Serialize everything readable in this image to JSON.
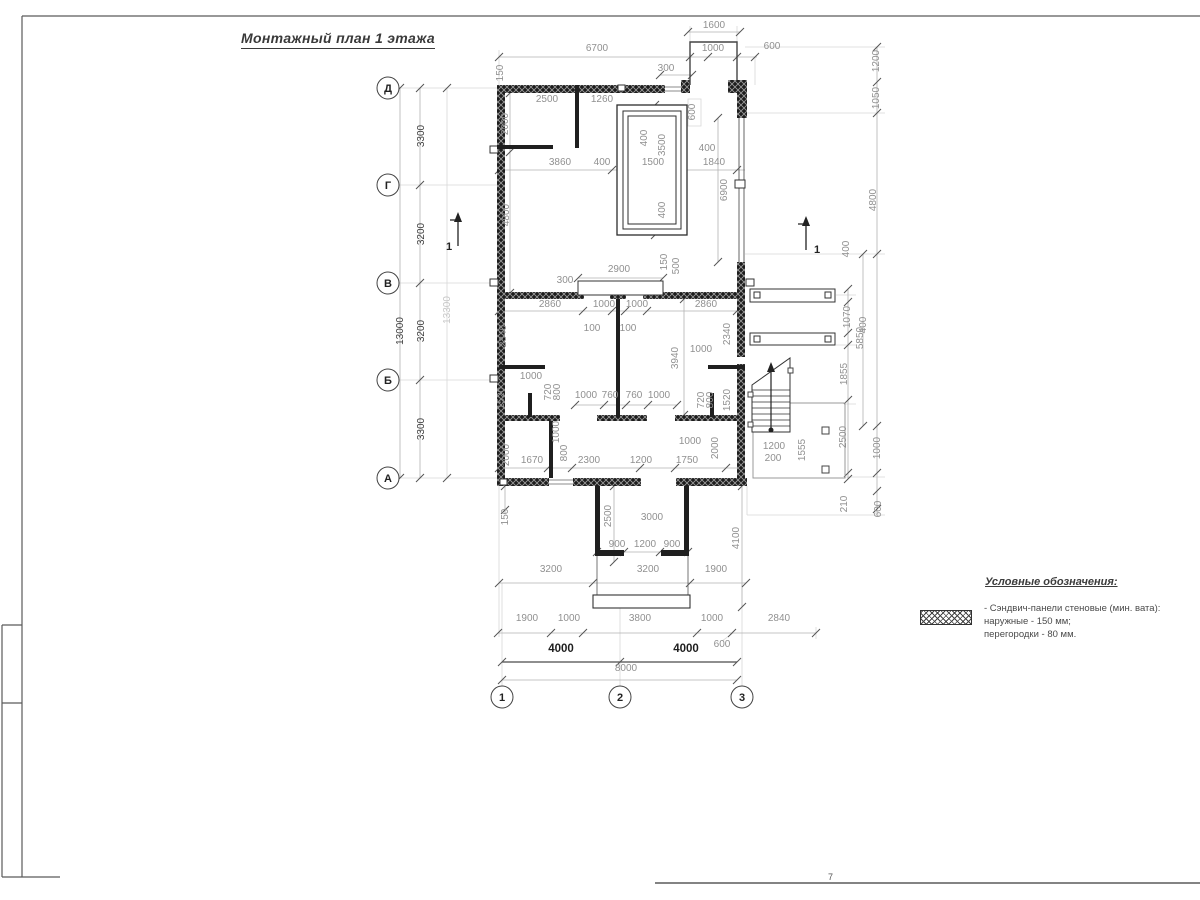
{
  "title": "Монтажный план 1 этажа",
  "sheet": {
    "corner_mark": "7"
  },
  "axes": {
    "left": [
      "Д",
      "Г",
      "В",
      "Б",
      "А"
    ],
    "bottom": [
      "1",
      "2",
      "3"
    ]
  },
  "sections": [
    "1",
    "1"
  ],
  "legend": {
    "heading": "Условные обозначения:",
    "symbol": "wall-panel-crosshatch",
    "lines": [
      "- Сэндвич-панели стеновые (мин. вата):",
      "наружные - 150 мм;",
      "перегородки - 80 мм."
    ]
  },
  "dimension_labels": [
    {
      "t": "1600",
      "x": 714,
      "y": 28
    },
    {
      "t": "6700",
      "x": 597,
      "y": 51
    },
    {
      "t": "1000",
      "x": 713,
      "y": 51
    },
    {
      "t": "600",
      "x": 772,
      "y": 49
    },
    {
      "t": "300",
      "x": 666,
      "y": 71
    },
    {
      "t": "150",
      "x": 503,
      "y": 73,
      "r": -90
    },
    {
      "t": "2500",
      "x": 547,
      "y": 102
    },
    {
      "t": "1260",
      "x": 602,
      "y": 102
    },
    {
      "t": "2000",
      "x": 508,
      "y": 124,
      "r": -90
    },
    {
      "t": "600",
      "x": 695,
      "y": 112,
      "r": -90
    },
    {
      "t": "400",
      "x": 647,
      "y": 138,
      "r": -90
    },
    {
      "t": "3500",
      "x": 665,
      "y": 145,
      "r": -90
    },
    {
      "t": "400",
      "x": 707,
      "y": 151
    },
    {
      "t": "3860",
      "x": 560,
      "y": 165
    },
    {
      "t": "400",
      "x": 602,
      "y": 165
    },
    {
      "t": "1500",
      "x": 653,
      "y": 165
    },
    {
      "t": "1840",
      "x": 714,
      "y": 165
    },
    {
      "t": "400",
      "x": 665,
      "y": 210,
      "r": -90
    },
    {
      "t": "4800",
      "x": 509,
      "y": 215,
      "r": -90
    },
    {
      "t": "6900",
      "x": 727,
      "y": 190,
      "r": -90
    },
    {
      "t": "3300",
      "x": 424,
      "y": 136,
      "r": -90,
      "c": "d"
    },
    {
      "t": "3200",
      "x": 424,
      "y": 234,
      "r": -90,
      "c": "d"
    },
    {
      "t": "3200",
      "x": 424,
      "y": 331,
      "r": -90,
      "c": "d"
    },
    {
      "t": "3300",
      "x": 424,
      "y": 429,
      "r": -90,
      "c": "d"
    },
    {
      "t": "13000",
      "x": 403,
      "y": 331,
      "r": -90,
      "c": "d"
    },
    {
      "t": "13300",
      "x": 450,
      "y": 310,
      "r": -90,
      "c": "lt"
    },
    {
      "t": "2900",
      "x": 619,
      "y": 272
    },
    {
      "t": "300",
      "x": 565,
      "y": 283
    },
    {
      "t": "150",
      "x": 667,
      "y": 262,
      "r": -90
    },
    {
      "t": "500",
      "x": 679,
      "y": 266,
      "r": -90
    },
    {
      "t": "2860",
      "x": 550,
      "y": 307
    },
    {
      "t": "1000",
      "x": 604,
      "y": 307
    },
    {
      "t": "1000",
      "x": 637,
      "y": 307
    },
    {
      "t": "2860",
      "x": 706,
      "y": 307
    },
    {
      "t": "100",
      "x": 592,
      "y": 331
    },
    {
      "t": "100",
      "x": 628,
      "y": 331
    },
    {
      "t": "2340",
      "x": 506,
      "y": 336,
      "r": -90
    },
    {
      "t": "2340",
      "x": 730,
      "y": 334,
      "r": -90
    },
    {
      "t": "3940",
      "x": 678,
      "y": 358,
      "r": -90
    },
    {
      "t": "1000",
      "x": 701,
      "y": 352
    },
    {
      "t": "1000",
      "x": 531,
      "y": 379
    },
    {
      "t": "720",
      "x": 551,
      "y": 392,
      "r": -90
    },
    {
      "t": "800",
      "x": 560,
      "y": 392,
      "r": -90
    },
    {
      "t": "1520",
      "x": 504,
      "y": 398,
      "r": -90
    },
    {
      "t": "1000",
      "x": 586,
      "y": 398
    },
    {
      "t": "760",
      "x": 610,
      "y": 398
    },
    {
      "t": "760",
      "x": 634,
      "y": 398
    },
    {
      "t": "1000",
      "x": 659,
      "y": 398
    },
    {
      "t": "720",
      "x": 704,
      "y": 400,
      "r": -90
    },
    {
      "t": "800",
      "x": 713,
      "y": 400,
      "r": -90
    },
    {
      "t": "1520",
      "x": 730,
      "y": 400,
      "r": -90
    },
    {
      "t": "1000",
      "x": 559,
      "y": 432,
      "r": -90
    },
    {
      "t": "800",
      "x": 567,
      "y": 453,
      "r": -90
    },
    {
      "t": "2000",
      "x": 509,
      "y": 455,
      "r": -90
    },
    {
      "t": "1670",
      "x": 532,
      "y": 463
    },
    {
      "t": "2300",
      "x": 589,
      "y": 463
    },
    {
      "t": "1200",
      "x": 641,
      "y": 463
    },
    {
      "t": "1750",
      "x": 687,
      "y": 463
    },
    {
      "t": "1000",
      "x": 690,
      "y": 444
    },
    {
      "t": "2000",
      "x": 718,
      "y": 448,
      "r": -90
    },
    {
      "t": "1200",
      "x": 774,
      "y": 449
    },
    {
      "t": "200",
      "x": 773,
      "y": 461
    },
    {
      "t": "1555",
      "x": 805,
      "y": 450,
      "r": -90
    },
    {
      "t": "1200",
      "x": 879,
      "y": 61,
      "r": -90
    },
    {
      "t": "1050",
      "x": 879,
      "y": 98,
      "r": -90
    },
    {
      "t": "4800",
      "x": 876,
      "y": 200,
      "r": -90
    },
    {
      "t": "400",
      "x": 849,
      "y": 249,
      "r": -90
    },
    {
      "t": "1070",
      "x": 850,
      "y": 317,
      "r": -90
    },
    {
      "t": "400",
      "x": 866,
      "y": 325,
      "r": -90
    },
    {
      "t": "5850",
      "x": 863,
      "y": 338,
      "r": -90
    },
    {
      "t": "1855",
      "x": 847,
      "y": 374,
      "r": -90
    },
    {
      "t": "2500",
      "x": 846,
      "y": 437,
      "r": -90
    },
    {
      "t": "1000",
      "x": 880,
      "y": 448,
      "r": -90
    },
    {
      "t": "210",
      "x": 847,
      "y": 504,
      "r": -90
    },
    {
      "t": "600",
      "x": 881,
      "y": 509,
      "r": -90
    },
    {
      "t": "150",
      "x": 508,
      "y": 517,
      "r": -90
    },
    {
      "t": "2500",
      "x": 611,
      "y": 516,
      "r": -90
    },
    {
      "t": "3000",
      "x": 652,
      "y": 520
    },
    {
      "t": "900",
      "x": 617,
      "y": 547
    },
    {
      "t": "1200",
      "x": 645,
      "y": 547
    },
    {
      "t": "900",
      "x": 672,
      "y": 547
    },
    {
      "t": "4100",
      "x": 739,
      "y": 538,
      "r": -90
    },
    {
      "t": "3200",
      "x": 551,
      "y": 572
    },
    {
      "t": "3200",
      "x": 648,
      "y": 572
    },
    {
      "t": "1900",
      "x": 716,
      "y": 572
    },
    {
      "t": "1900",
      "x": 527,
      "y": 621
    },
    {
      "t": "1000",
      "x": 569,
      "y": 621
    },
    {
      "t": "3800",
      "x": 640,
      "y": 621
    },
    {
      "t": "1000",
      "x": 712,
      "y": 621
    },
    {
      "t": "2840",
      "x": 779,
      "y": 621
    },
    {
      "t": "600",
      "x": 722,
      "y": 647
    },
    {
      "t": "4000",
      "x": 561,
      "y": 652,
      "c": "b"
    },
    {
      "t": "4000",
      "x": 686,
      "y": 652,
      "c": "b"
    },
    {
      "t": "8000",
      "x": 626,
      "y": 671
    }
  ]
}
